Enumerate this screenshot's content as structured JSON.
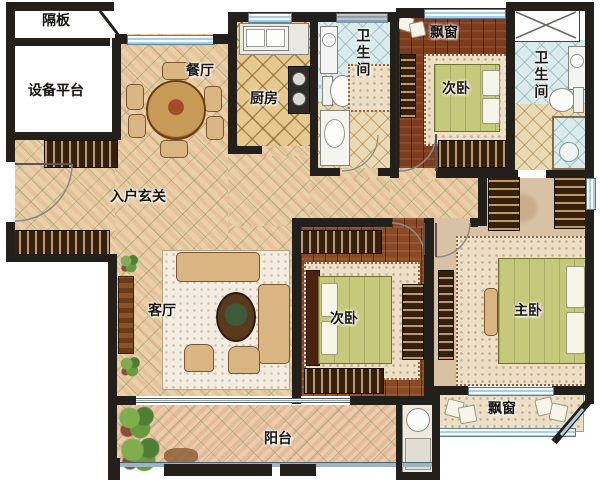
{
  "plan": {
    "title": "three-bedroom apartment floor plan",
    "labels": {
      "partition": "隔板",
      "equipment_platform": "设备平台",
      "dining": "餐厅",
      "kitchen": "厨房",
      "bath1": "卫生间",
      "bath2": "卫生间",
      "bay_window_top": "飘窗",
      "bedroom1": "次卧",
      "entry_hall": "入户玄关",
      "living": "客厅",
      "bedroom2": "次卧",
      "master": "主卧",
      "balcony": "阳台",
      "bay_window_bottom": "飘窗"
    },
    "fixtures": {
      "dining_table": "round dining table with six chairs",
      "sofa_set": "sofa group with coffee table",
      "tv_console": "tv console",
      "kitchen_sink": "double kitchen sink",
      "stove": "two-burner stove",
      "toilet": "toilet",
      "shower": "shower",
      "washbasin": "washbasin",
      "wardrobe": "wardrobe with hangers",
      "double_bed": "double bed with green bedding",
      "plants": "balcony plants",
      "door_arc": "door swing arc",
      "shaft": "duct shaft (crossed box)"
    },
    "colors": {
      "wall": "#23201c",
      "window": "#a9cde2",
      "tile_floor": "#ead0a6",
      "balcony_floor": "#eccdab",
      "kitchen_floor": "#e6c98e",
      "bath_teal_floor": "#d9eceb",
      "bath_beige_floor": "#e9dab4",
      "wood_floor": "#8a4a26",
      "marble_floor": "#d8c2a3",
      "bed_green": "#c6c97c",
      "wardrobe_dark": "#33200e",
      "sofa_tan": "#d9b582"
    }
  }
}
